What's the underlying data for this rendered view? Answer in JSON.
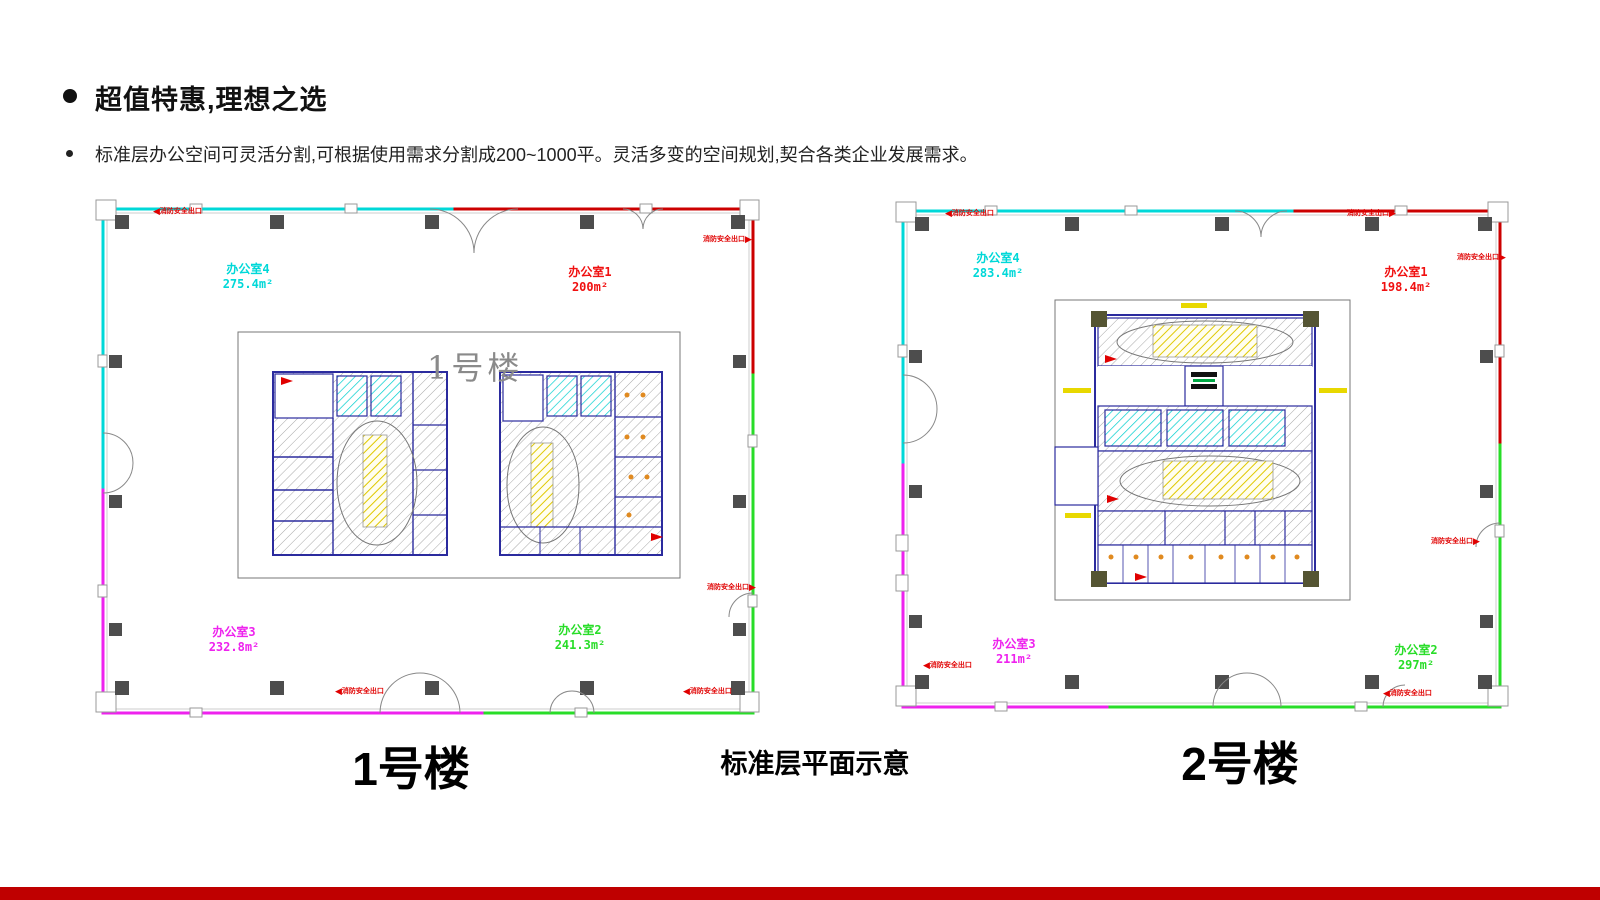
{
  "slide": {
    "title": "超值特惠,理想之选",
    "bullet": "标准层办公空间可灵活分割,可根据使用需求分割成200~1000平。灵活多变的空间规划,契合各类企业发展需求。",
    "caption_left": "1号楼",
    "caption_center": "标准层平面示意",
    "caption_right": "2号楼",
    "accent_color": "#bf0000"
  },
  "plan1": {
    "name": "1号楼",
    "watermark": "1号楼",
    "fire_exit_label": "消防安全出口",
    "office4": {
      "label": "办公室4",
      "area": "275.4m²",
      "color": "#00d8d8"
    },
    "office1": {
      "label": "办公室1",
      "area": "200m²",
      "color": "#f01010"
    },
    "office3": {
      "label": "办公室3",
      "area": "232.8m²",
      "color": "#ee22ee"
    },
    "office2": {
      "label": "办公室2",
      "area": "241.3m²",
      "color": "#28dd28"
    }
  },
  "plan2": {
    "name": "2号楼",
    "fire_exit_label": "消防安全出口",
    "office4": {
      "label": "办公室4",
      "area": "283.4m²",
      "color": "#00d8d8"
    },
    "office1": {
      "label": "办公室1",
      "area": "198.4m²",
      "color": "#f01010"
    },
    "office3": {
      "label": "办公室3",
      "area": "211m²",
      "color": "#ee22ee"
    },
    "office2": {
      "label": "办公室2",
      "area": "297m²",
      "color": "#28dd28"
    }
  }
}
